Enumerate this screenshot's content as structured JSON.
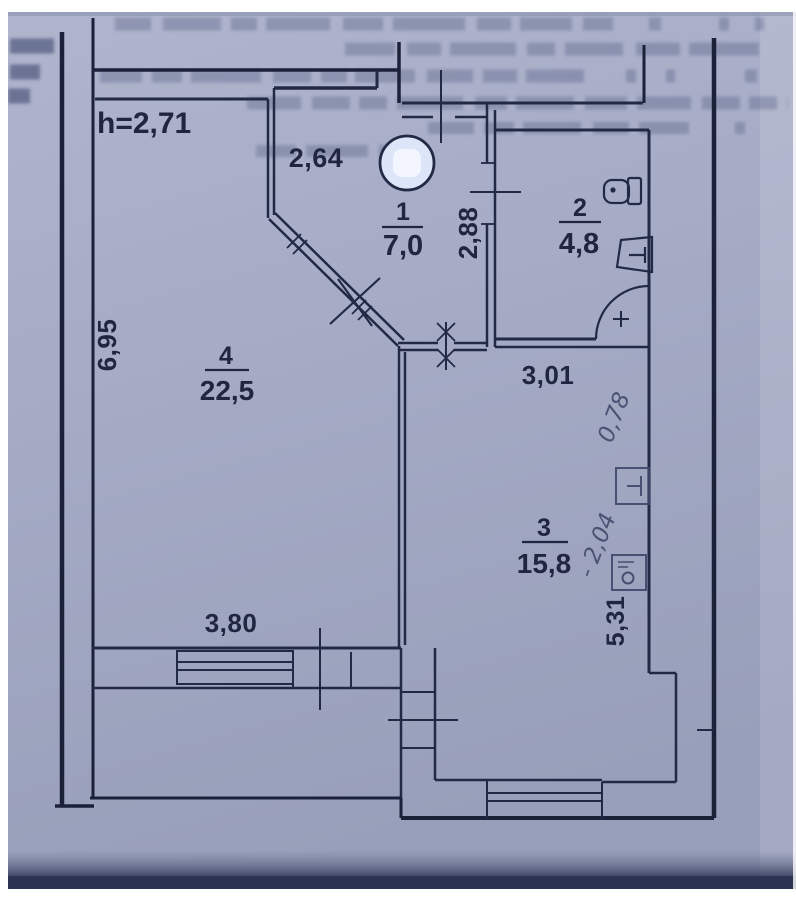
{
  "plan": {
    "ceiling_height": "h=2,71",
    "rooms": [
      {
        "number": "1",
        "area": "7,0"
      },
      {
        "number": "2",
        "area": "4,8"
      },
      {
        "number": "3",
        "area": "15,8"
      },
      {
        "number": "4",
        "area": "22,5"
      }
    ],
    "dimensions": {
      "top_niche_width": "2,64",
      "entry_side": "2,88",
      "hall_width": "3,01",
      "room4_side": "6,95",
      "room4_width": "3,80",
      "room3_side": "5,31"
    },
    "handwritten": {
      "note_1": "0,78",
      "note_2": "- 2,04"
    },
    "icons": [
      "round-fixture-icon",
      "toilet-icon",
      "sink-icon",
      "door-swing-arc-icon",
      "plus-mark-icon",
      "handwritten-sink-icon",
      "handwritten-appliance-icon"
    ],
    "colors": {
      "paper": "#a5abc5",
      "ink": "#222944",
      "pencil": "#3e466a"
    }
  }
}
